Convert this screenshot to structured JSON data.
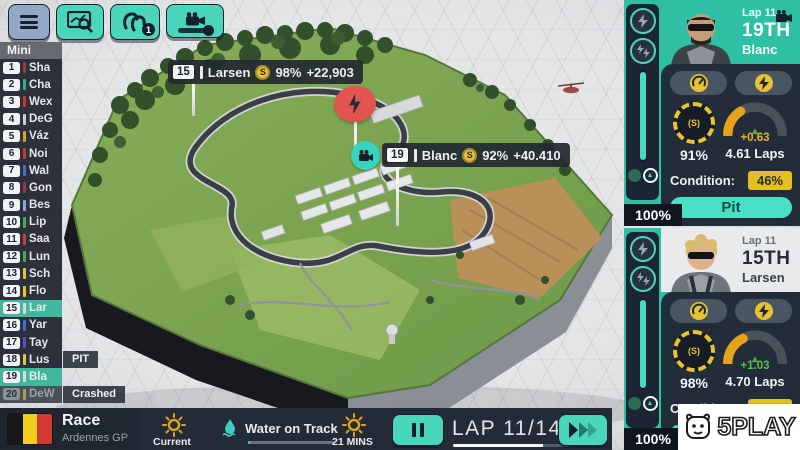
{
  "toolbar": {
    "radio_badge": "1"
  },
  "standings": {
    "header": "Mini",
    "rows": [
      {
        "pos": "1",
        "code": "Sha",
        "color": "#a8323e"
      },
      {
        "pos": "2",
        "code": "Cha",
        "color": "#2fae8f"
      },
      {
        "pos": "3",
        "code": "Wex",
        "color": "#d2342a"
      },
      {
        "pos": "4",
        "code": "DeG",
        "color": "#c9ced3"
      },
      {
        "pos": "5",
        "code": "Váz",
        "color": "#d9a521"
      },
      {
        "pos": "6",
        "code": "Noi",
        "color": "#c23b32"
      },
      {
        "pos": "7",
        "code": "Wal",
        "color": "#3e6fd0"
      },
      {
        "pos": "8",
        "code": "Gon",
        "color": "#9e3547"
      },
      {
        "pos": "9",
        "code": "Bes",
        "color": "#8ea6dd"
      },
      {
        "pos": "10",
        "code": "Lip",
        "color": "#3faf52"
      },
      {
        "pos": "11",
        "code": "Saa",
        "color": "#cf4038"
      },
      {
        "pos": "12",
        "code": "Lun",
        "color": "#3faf52"
      },
      {
        "pos": "13",
        "code": "Sch",
        "color": "#e3c52c"
      },
      {
        "pos": "14",
        "code": "Flo",
        "color": "#e3c52c"
      },
      {
        "pos": "15",
        "code": "Lar",
        "color": "#d6dade"
      },
      {
        "pos": "16",
        "code": "Yar",
        "color": "#3e6fd0"
      },
      {
        "pos": "17",
        "code": "Tay",
        "color": "#5a4fc0"
      },
      {
        "pos": "18",
        "code": "Lus",
        "color": "#e3c52c",
        "status": "PIT"
      },
      {
        "pos": "19",
        "code": "Bla",
        "color": "#d6dade"
      },
      {
        "pos": "20",
        "code": "DeW",
        "color": "#b0a23a",
        "status": "Crashed"
      }
    ]
  },
  "track_markers": [
    {
      "pos": "15",
      "name": "Larsen",
      "tyre": "S",
      "tyre_pct": "98%",
      "gap": "+22,903"
    },
    {
      "pos": "19",
      "name": "Blanc",
      "tyre": "S",
      "tyre_pct": "92%",
      "gap": "+40.410"
    }
  ],
  "driver_panels": [
    {
      "lap": "Lap 11",
      "position": "19TH",
      "name": "Blanc",
      "tyre_symbol": "(S)",
      "tyre_pct": "91%",
      "fuel_delta": "+0.63",
      "fuel_delta_color": "#e8b428",
      "fuel_laps": "4.61 Laps",
      "condition_label": "Condition:",
      "condition_pct": "46%",
      "pit_label": "Pit",
      "slider_value": "100%"
    },
    {
      "lap": "Lap 11",
      "position": "15TH",
      "name": "Larsen",
      "tyre_symbol": "(S)",
      "tyre_pct": "98%",
      "fuel_delta": "+1.03",
      "fuel_delta_color": "#57c24d",
      "fuel_laps": "4.70 Laps",
      "condition_label": "Condition:",
      "condition_pct": "25%",
      "pit_label": "Pit",
      "slider_value": "100%"
    }
  ],
  "bottom_bar": {
    "session": "Race",
    "event": "Ardennes GP",
    "flag_colors": {
      "left": "#17181a",
      "mid": "#f2cf1d",
      "right": "#d03a32"
    },
    "weather_now_label": "Current",
    "water_label": "Water on Track",
    "water_level_pct": 2,
    "time_remaining": "21 MINS",
    "lap_label": "LAP 11/14",
    "lap_progress_pct": 78
  },
  "watermark": {
    "text": "5PLAY"
  }
}
